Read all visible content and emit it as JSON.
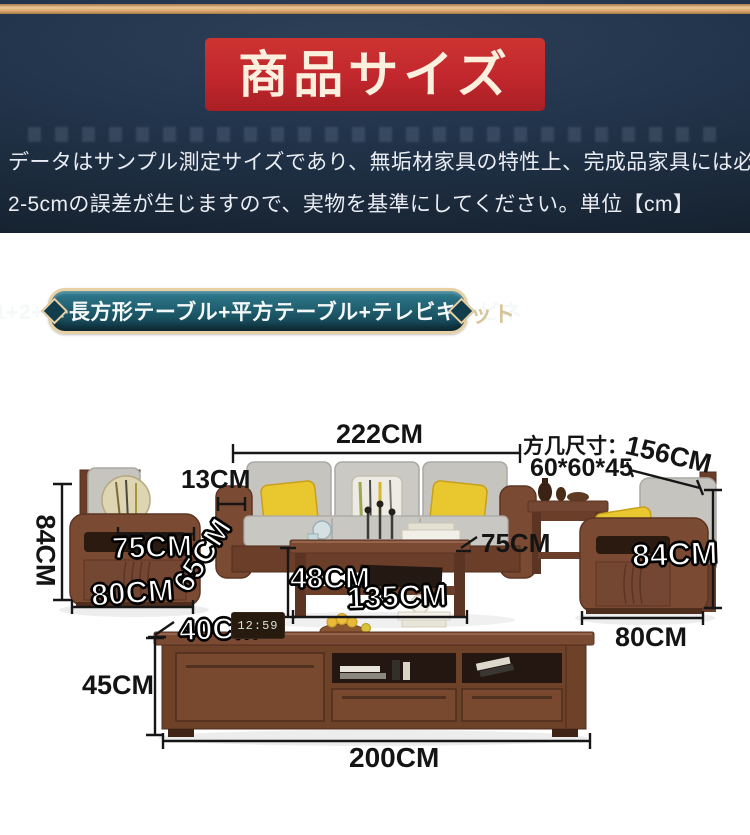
{
  "header": {
    "title": "商品サイズ",
    "description_line1": "データはサンプル測定サイズであり、無垢材家具の特性上、完成品家具には必",
    "description_line2": "2-5cmの誤差が生じますので、実物を基準にしてください。単位【cm】"
  },
  "banner": {
    "label": "1+2+3+長方形テーブル+平方テーブル+テレビキャビネ",
    "overflow": "ット"
  },
  "diagram": {
    "labels": [
      {
        "id": "sofa-width",
        "text": "222CM"
      },
      {
        "id": "armrest-width",
        "text": "13CM"
      },
      {
        "id": "square-table-caption",
        "text": "方几尺寸："
      },
      {
        "id": "square-table-length",
        "text": "156CM"
      },
      {
        "id": "square-table-size",
        "text": "60*60*45"
      },
      {
        "id": "left-sofa-height",
        "text": "84CM"
      },
      {
        "id": "left-seat-depth",
        "text": "75CM"
      },
      {
        "id": "left-sofa-depth",
        "text": "65CM"
      },
      {
        "id": "left-sofa-width",
        "text": "80CM"
      },
      {
        "id": "coffee-table-height",
        "text": "48CM"
      },
      {
        "id": "coffee-table-width",
        "text": "135CM"
      },
      {
        "id": "right-seat-depth",
        "text": "75CM"
      },
      {
        "id": "right-sofa-height",
        "text": "84CM"
      },
      {
        "id": "right-sofa-width",
        "text": "80CM"
      },
      {
        "id": "tv-stand-depth",
        "text": "40CM"
      },
      {
        "id": "tv-stand-height",
        "text": "45CM"
      },
      {
        "id": "tv-stand-width",
        "text": "200CM"
      }
    ],
    "clock_time": "12:59"
  },
  "colors": {
    "accent_red": "#c1272d",
    "navy_bg": "#22344b",
    "gold_line": "#d9a76c",
    "pill_teal": "#1d5969",
    "pill_border": "#e7d0a4",
    "wood": "#7b4a33",
    "cushion_gray": "#c6c4bf",
    "pillow_yellow": "#e9c72f"
  }
}
